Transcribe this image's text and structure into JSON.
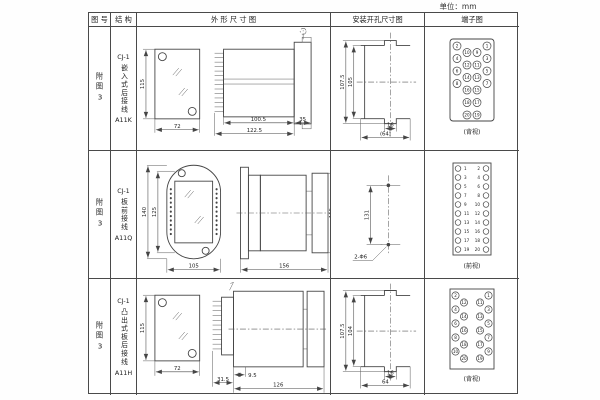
{
  "unit_label": "单位：mm",
  "table": {
    "headers": {
      "fig_no": "图 号",
      "structure": "结 构",
      "outline": "外 形 尺 寸 图",
      "install": "安装开孔尺寸图",
      "terminal": "端子图"
    }
  },
  "rows": [
    {
      "fig_no": "附图3",
      "structure": {
        "series": "CJ-1",
        "mount": "嵌入式后接线",
        "model": "A11K"
      },
      "outline_dims": {
        "height": "115",
        "width": "72",
        "body_depth": "100.5",
        "total_depth": "122.5",
        "flange_depth": "35"
      },
      "install_dims": {
        "outer_height": "107.5",
        "inner_height": "105",
        "slot_width": "16",
        "overall_width": "(64)"
      },
      "terminal": {
        "view_label": "(背视)",
        "layout": "rear-staggered",
        "columns": {
          "outer_left": [
            2,
            4,
            6,
            8
          ],
          "inner_left": [
            10,
            12,
            14,
            16,
            18,
            20
          ],
          "inner_right": [
            9,
            11,
            13,
            15,
            17,
            19
          ],
          "outer_right": [
            1,
            3,
            5,
            7
          ]
        }
      }
    },
    {
      "fig_no": "附图3",
      "structure": {
        "series": "CJ-1",
        "mount": "板前接线",
        "model": "A11Q"
      },
      "outline_dims": {
        "outer_height": "140",
        "inner_height": "125",
        "width": "105",
        "depth": "156",
        "side_height": "115"
      },
      "install_dims": {
        "hole_spacing": "131",
        "hole_label": "2-Φ6"
      },
      "terminal": {
        "view_label": "(前视)",
        "layout": "front-columns",
        "columns": {
          "left": [
            1,
            3,
            5,
            7,
            9,
            11,
            13,
            15,
            17,
            19
          ],
          "right": [
            2,
            4,
            6,
            8,
            10,
            12,
            14,
            16,
            18,
            20
          ]
        }
      }
    },
    {
      "fig_no": "附图3",
      "structure": {
        "series": "CJ-1",
        "mount": "凸出式板后接线",
        "model": "A11H"
      },
      "outline_dims": {
        "height": "115",
        "width": "72",
        "stub_depth": "9.5",
        "terminal_depth": "31.5",
        "body_depth": "126"
      },
      "install_dims": {
        "outer_height": "107.5",
        "inner_height": "104",
        "slot_width": "16",
        "overall_width": "64"
      },
      "terminal": {
        "view_label": "(背视)",
        "layout": "rear-zigzag",
        "columns": {
          "left_outer": [
            2,
            4,
            6,
            8,
            10
          ],
          "left_inner": [
            12,
            14,
            16,
            18,
            20
          ],
          "right_inner": [
            11,
            13,
            15,
            17,
            19
          ],
          "right_outer": [
            1,
            3,
            5,
            7,
            9
          ]
        }
      }
    }
  ]
}
